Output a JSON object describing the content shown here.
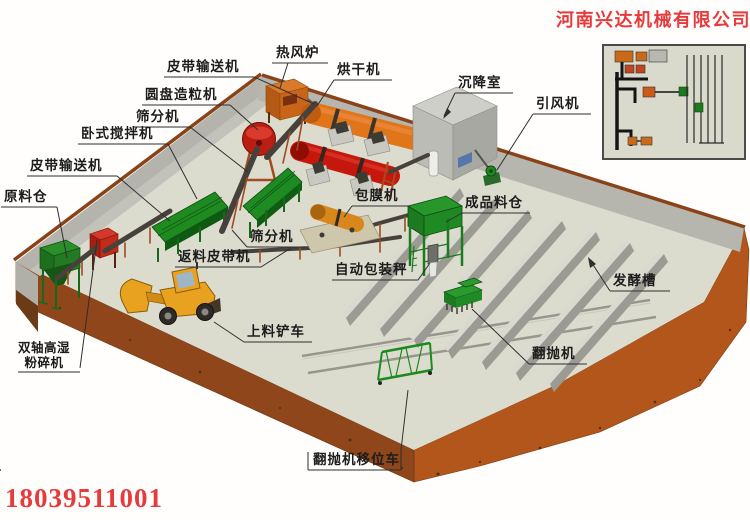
{
  "branding": {
    "company_name": "河南兴达机械有限公司",
    "phone": "18039511001",
    "brand_color": "#e63a3c"
  },
  "labels": {
    "belt_conveyor_top": {
      "text": "皮带输送机"
    },
    "disc_granulator": {
      "text": "圆盘造粒机"
    },
    "screen_upper": {
      "text": "筛分机"
    },
    "horizontal_mixer": {
      "text": "卧式搅拌机"
    },
    "belt_conveyor_left": {
      "text": "皮带输送机"
    },
    "raw_material_bin": {
      "text": "原料仓"
    },
    "hot_air_furnace": {
      "text": "热风炉"
    },
    "dryer": {
      "text": "烘干机"
    },
    "settling_chamber": {
      "text": "沉降室"
    },
    "induced_draft_fan": {
      "text": "引风机"
    },
    "coating_machine": {
      "text": "包膜机"
    },
    "finished_product_bin": {
      "text": "成品料仓"
    },
    "screen_lower": {
      "text": "筛分机"
    },
    "return_belt": {
      "text": "返料皮带机"
    },
    "auto_packing_scale": {
      "text": "自动包装秤"
    },
    "fermentation_trough": {
      "text": "发酵槽"
    },
    "loader": {
      "text": "上料铲车"
    },
    "crusher": {
      "line1": "双轴高湿",
      "line2": "粉碎机"
    },
    "compost_turner": {
      "text": "翻抛机"
    },
    "turner_shifting_cart": {
      "text": "翻抛机移位车"
    }
  },
  "colors": {
    "floor": "#dcdcce",
    "slab_side_right": "#b2561c",
    "slab_side_front": "#8e461a",
    "wall_gray": "#bdbdb5",
    "wall_trim_brown": "#8a4319",
    "machine_green": "#1f8a1f",
    "drum_red": "#c6170c",
    "dryer_orange": "#e0751a",
    "loader_yellow": "#e8a21f",
    "label_text": "#1c1c1c"
  }
}
